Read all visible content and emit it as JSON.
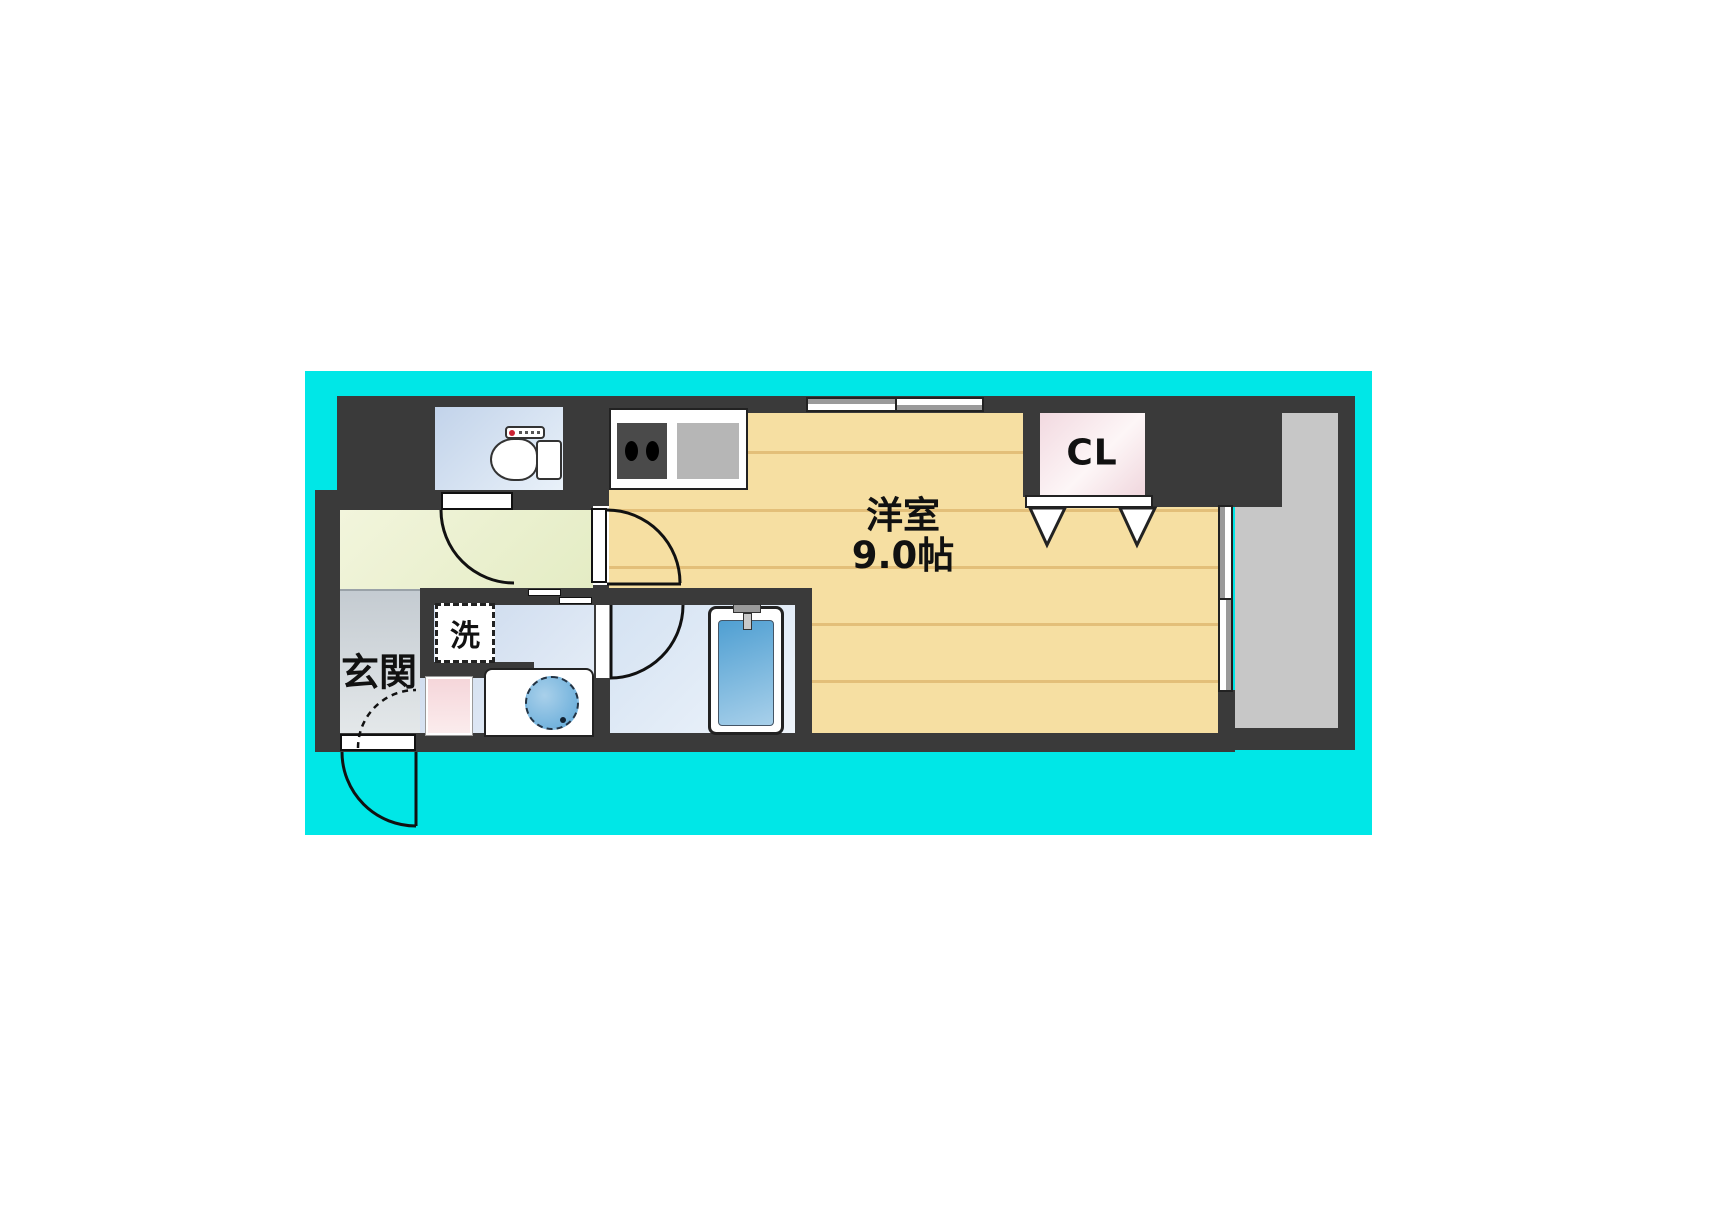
{
  "floor_plan": {
    "labels": {
      "entrance": "玄関",
      "laundry": "洗",
      "closet": "CL",
      "main_room_name": "洋室",
      "main_room_size": "9.0帖"
    },
    "colors": {
      "background_cyan": "#00e7e7",
      "wall_dark": "#3a3a3a",
      "main_room_floor": "#f6dfa2",
      "floor_line": "#e3bf79",
      "balcony_gray": "#c7c7c7",
      "closet_pink": "#f6dee4",
      "hall_green": "#eff3d8",
      "entrance_gray": "#ccd2d6",
      "wet_area_blue": "#cfdcee",
      "bathtub_blue": "#5fa8d8",
      "toilet_button_red": "#cc2233",
      "stove_dark": "#4a4a4a",
      "sink_gray": "#b6b6b6"
    }
  }
}
